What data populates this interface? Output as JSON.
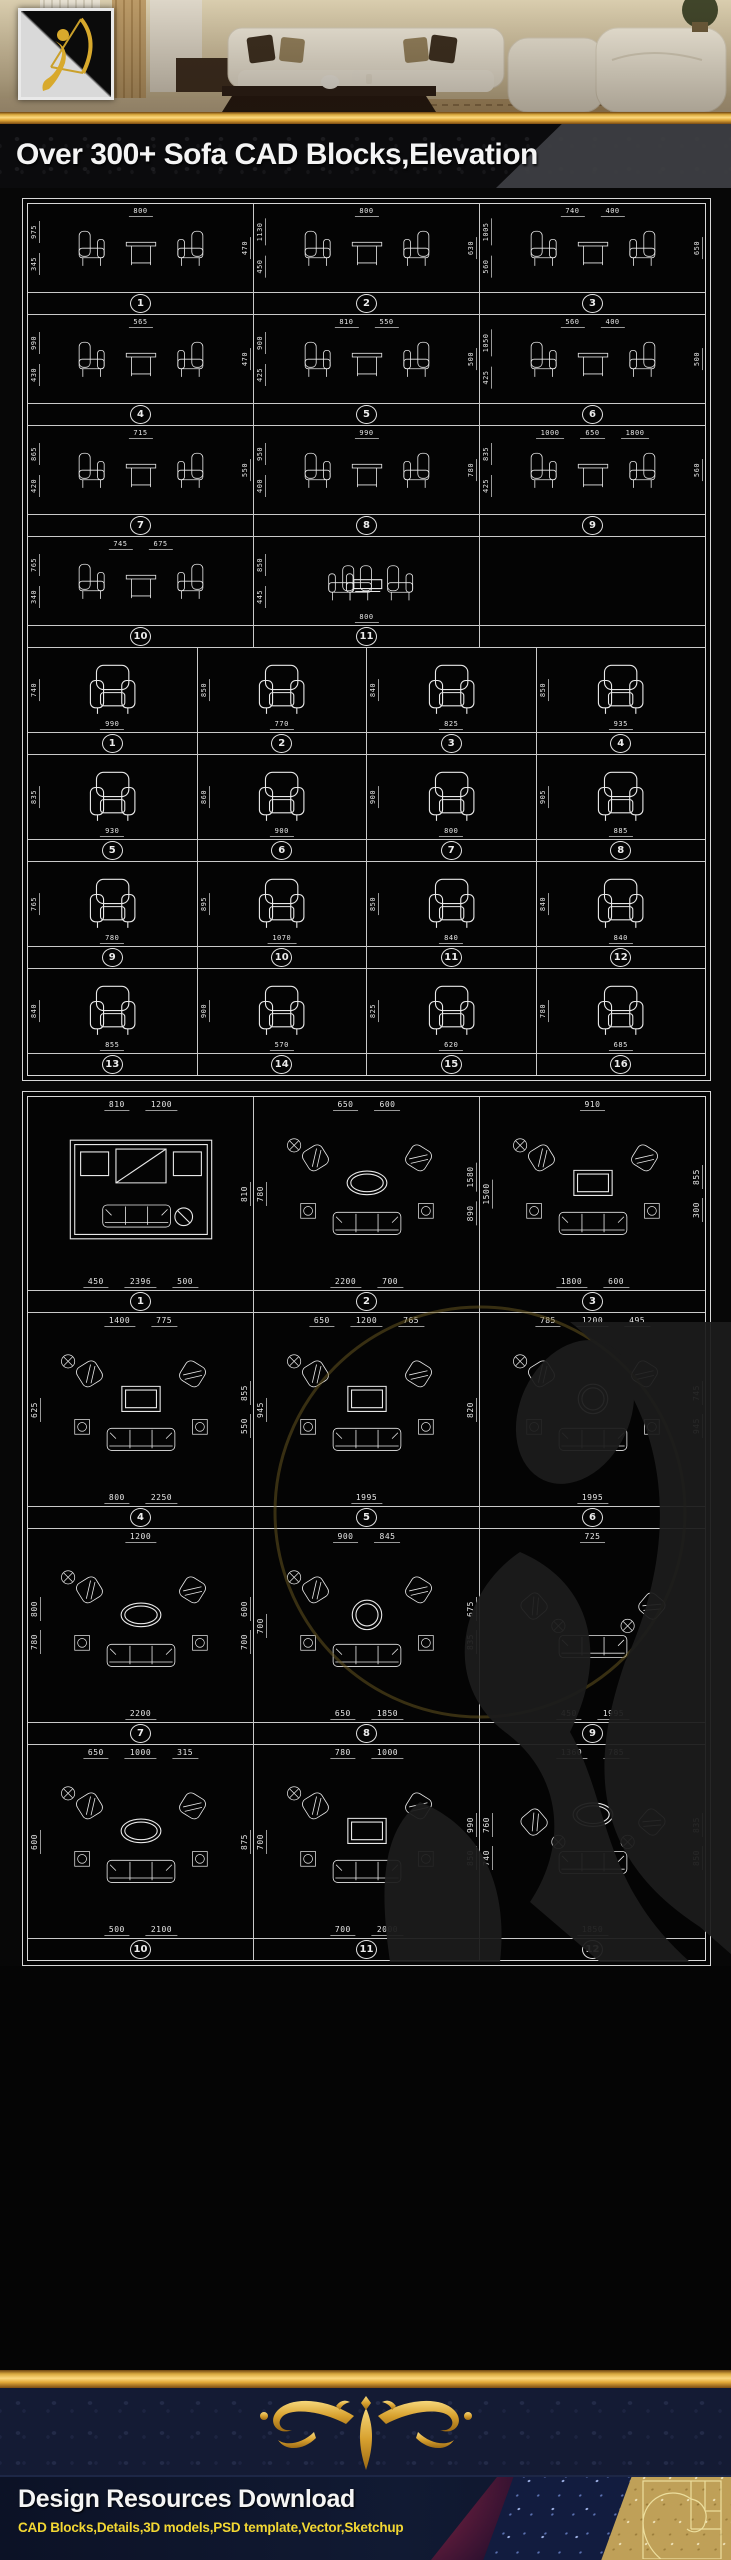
{
  "title": {
    "text": "Over 300+ Sofa CAD Blocks,Elevation"
  },
  "banner": {
    "logo": "archer-gold-logo",
    "scene": "living-room-photo"
  },
  "colors": {
    "gold": "#e2a838",
    "line": "#e8e8e8",
    "navy": "#141b34",
    "yellow": "#f2d733"
  },
  "footer": {
    "heading": "Design Resources Download",
    "subheading": "CAD Blocks,Details,3D models,PSD template,Vector,Sketchup"
  },
  "sheet1_pairs": {
    "cols": 3,
    "items": [
      {
        "num": "1",
        "variant": "pair",
        "dims": {
          "top": [
            "800"
          ],
          "left": [
            "975",
            "345"
          ],
          "right": [
            "470"
          ],
          "bottom": []
        }
      },
      {
        "num": "2",
        "variant": "pair",
        "dims": {
          "top": [
            "800"
          ],
          "left": [
            "1130",
            "450"
          ],
          "right": [
            "630"
          ],
          "bottom": []
        }
      },
      {
        "num": "3",
        "variant": "pair",
        "dims": {
          "top": [
            "740",
            "400"
          ],
          "left": [
            "1005",
            "560"
          ],
          "right": [
            "650"
          ],
          "bottom": []
        }
      },
      {
        "num": "4",
        "variant": "pair",
        "dims": {
          "top": [
            "565"
          ],
          "left": [
            "990",
            "430"
          ],
          "right": [
            "470"
          ],
          "bottom": []
        }
      },
      {
        "num": "5",
        "variant": "pair",
        "dims": {
          "top": [
            "810",
            "550"
          ],
          "left": [
            "900",
            "425"
          ],
          "right": [
            "500"
          ],
          "bottom": []
        }
      },
      {
        "num": "6",
        "variant": "pair",
        "dims": {
          "top": [
            "560",
            "400"
          ],
          "left": [
            "1050",
            "425"
          ],
          "right": [
            "500"
          ],
          "bottom": []
        }
      },
      {
        "num": "7",
        "variant": "pair",
        "dims": {
          "top": [
            "715"
          ],
          "left": [
            "865",
            "420"
          ],
          "right": [
            "550"
          ],
          "bottom": []
        }
      },
      {
        "num": "8",
        "variant": "pair",
        "dims": {
          "top": [
            "990"
          ],
          "left": [
            "950",
            "400"
          ],
          "right": [
            "780"
          ],
          "bottom": []
        }
      },
      {
        "num": "9",
        "variant": "pair",
        "dims": {
          "top": [
            "1000",
            "650",
            "1800"
          ],
          "left": [
            "835",
            "425"
          ],
          "right": [
            "560"
          ],
          "bottom": []
        }
      },
      {
        "num": "10",
        "variant": "pair",
        "dims": {
          "top": [
            "745",
            "675"
          ],
          "left": [
            "765",
            "340"
          ],
          "right": [],
          "bottom": []
        }
      },
      {
        "num": "11",
        "variant": "facing",
        "dims": {
          "top": [],
          "left": [
            "850",
            "445"
          ],
          "right": [],
          "bottom": [
            "800"
          ]
        }
      },
      {
        "num": "",
        "variant": "empty",
        "dims": {
          "top": [],
          "left": [],
          "right": [],
          "bottom": []
        }
      }
    ]
  },
  "sheet1_singles": {
    "cols": 4,
    "items": [
      {
        "num": "1",
        "dims": {
          "left": [
            "740"
          ],
          "bottom": [
            "990"
          ]
        }
      },
      {
        "num": "2",
        "dims": {
          "left": [
            "850"
          ],
          "bottom": [
            "770"
          ]
        }
      },
      {
        "num": "3",
        "dims": {
          "left": [
            "840"
          ],
          "bottom": [
            "825"
          ]
        }
      },
      {
        "num": "4",
        "dims": {
          "left": [
            "850"
          ],
          "bottom": [
            "935"
          ]
        }
      },
      {
        "num": "5",
        "dims": {
          "left": [
            "835"
          ],
          "bottom": [
            "930"
          ]
        }
      },
      {
        "num": "6",
        "dims": {
          "left": [
            "860"
          ],
          "bottom": [
            "900"
          ]
        }
      },
      {
        "num": "7",
        "dims": {
          "left": [
            "900"
          ],
          "bottom": [
            "800"
          ]
        }
      },
      {
        "num": "8",
        "dims": {
          "left": [
            "905"
          ],
          "bottom": [
            "885"
          ]
        }
      },
      {
        "num": "9",
        "dims": {
          "left": [
            "765"
          ],
          "bottom": [
            "780"
          ]
        }
      },
      {
        "num": "10",
        "dims": {
          "left": [
            "895"
          ],
          "bottom": [
            "1070"
          ]
        }
      },
      {
        "num": "11",
        "dims": {
          "left": [
            "850"
          ],
          "bottom": [
            "840"
          ]
        }
      },
      {
        "num": "12",
        "dims": {
          "left": [
            "840"
          ],
          "bottom": [
            "840"
          ]
        }
      },
      {
        "num": "13",
        "dims": {
          "left": [
            "840"
          ],
          "bottom": [
            "855"
          ]
        }
      },
      {
        "num": "14",
        "dims": {
          "left": [
            "900"
          ],
          "bottom": [
            "570"
          ]
        }
      },
      {
        "num": "15",
        "dims": {
          "left": [
            "825"
          ],
          "bottom": [
            "620"
          ]
        }
      },
      {
        "num": "16",
        "dims": {
          "left": [
            "780"
          ],
          "bottom": [
            "685"
          ]
        }
      }
    ]
  },
  "sheet2_plans": {
    "cols": 3,
    "items": [
      {
        "num": "1",
        "variant": "room",
        "table": "rect",
        "dims": {
          "top": [
            "810",
            "1200"
          ],
          "left": [],
          "right": [
            "810"
          ],
          "bottom": [
            "450",
            "2396",
            "500"
          ]
        }
      },
      {
        "num": "2",
        "variant": "u",
        "table": "oval",
        "dims": {
          "top": [
            "650",
            "600"
          ],
          "left": [
            "780"
          ],
          "right": [
            "1580",
            "890"
          ],
          "bottom": [
            "2200",
            "700"
          ]
        }
      },
      {
        "num": "3",
        "variant": "u",
        "table": "rect",
        "dims": {
          "top": [
            "910"
          ],
          "left": [
            "1500"
          ],
          "right": [
            "855",
            "300"
          ],
          "bottom": [
            "1800",
            "600"
          ]
        }
      },
      {
        "num": "4",
        "variant": "u",
        "table": "rect",
        "dims": {
          "top": [
            "1400",
            "775"
          ],
          "left": [
            "625"
          ],
          "right": [
            "855",
            "550"
          ],
          "bottom": [
            "800",
            "2250"
          ]
        }
      },
      {
        "num": "5",
        "variant": "u",
        "table": "rect",
        "dims": {
          "top": [
            "650",
            "1200",
            "765"
          ],
          "left": [
            "945"
          ],
          "right": [
            "820"
          ],
          "bottom": [
            "1995"
          ]
        }
      },
      {
        "num": "6",
        "variant": "u",
        "table": "round",
        "dims": {
          "top": [
            "785",
            "1200",
            "495"
          ],
          "left": [],
          "right": [
            "745",
            "945"
          ],
          "bottom": [
            "1995"
          ]
        }
      },
      {
        "num": "7",
        "variant": "u",
        "table": "oval",
        "dims": {
          "top": [
            "1200"
          ],
          "left": [
            "800",
            "780"
          ],
          "right": [
            "600",
            "700"
          ],
          "bottom": [
            "2200"
          ]
        }
      },
      {
        "num": "8",
        "variant": "u",
        "table": "round",
        "dims": {
          "top": [
            "900",
            "845"
          ],
          "left": [
            "700"
          ],
          "right": [
            "675",
            "835"
          ],
          "bottom": [
            "650",
            "1850"
          ]
        }
      },
      {
        "num": "9",
        "variant": "wide",
        "table": "none",
        "dims": {
          "top": [
            "725"
          ],
          "left": [],
          "right": [],
          "bottom": [
            "450",
            "1995"
          ]
        }
      },
      {
        "num": "10",
        "variant": "u",
        "table": "oval",
        "dims": {
          "top": [
            "650",
            "1000",
            "315"
          ],
          "left": [
            "600"
          ],
          "right": [
            "875"
          ],
          "bottom": [
            "500",
            "2100"
          ]
        }
      },
      {
        "num": "11",
        "variant": "u",
        "table": "rect",
        "dims": {
          "top": [
            "780",
            "1000"
          ],
          "left": [
            "700"
          ],
          "right": [
            "990",
            "850"
          ],
          "bottom": [
            "700",
            "2000"
          ]
        }
      },
      {
        "num": "12",
        "variant": "wide",
        "table": "oval",
        "dims": {
          "top": [
            "1360",
            "785"
          ],
          "left": [
            "760",
            "740"
          ],
          "right": [
            "835",
            "850"
          ],
          "bottom": [
            "1850"
          ]
        }
      }
    ]
  }
}
